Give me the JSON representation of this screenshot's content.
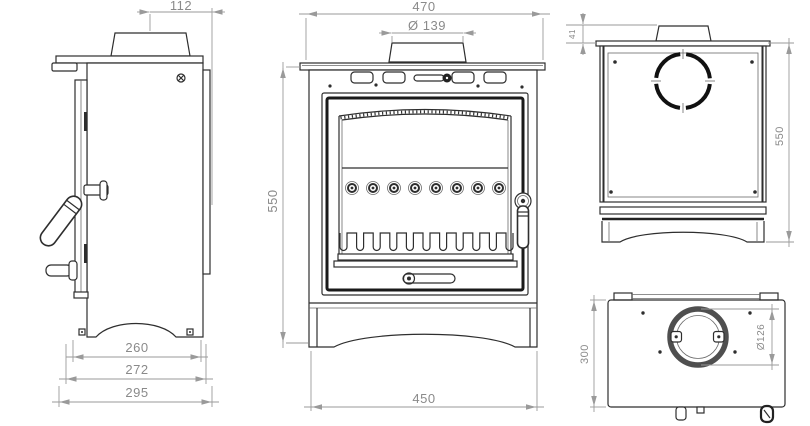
{
  "dims": {
    "side": {
      "flue_center_to_back": "112",
      "base_width": "260",
      "body_depth": "272",
      "overall_depth": "295"
    },
    "front": {
      "overall_width": "470",
      "flue_diameter": "Ø 139",
      "overall_height": "550",
      "base_width": "450"
    },
    "back": {
      "collar_height": "41",
      "overall_height": "550"
    },
    "top": {
      "depth": "300",
      "flue_spigot_diameter": "Ø126"
    }
  },
  "colors": {
    "background": "#ffffff",
    "line_dark": "#2e2e2e",
    "line_heavy": "#1a1a1a",
    "dim_line": "#9a9a9a",
    "dim_text": "#8a8a8a"
  }
}
